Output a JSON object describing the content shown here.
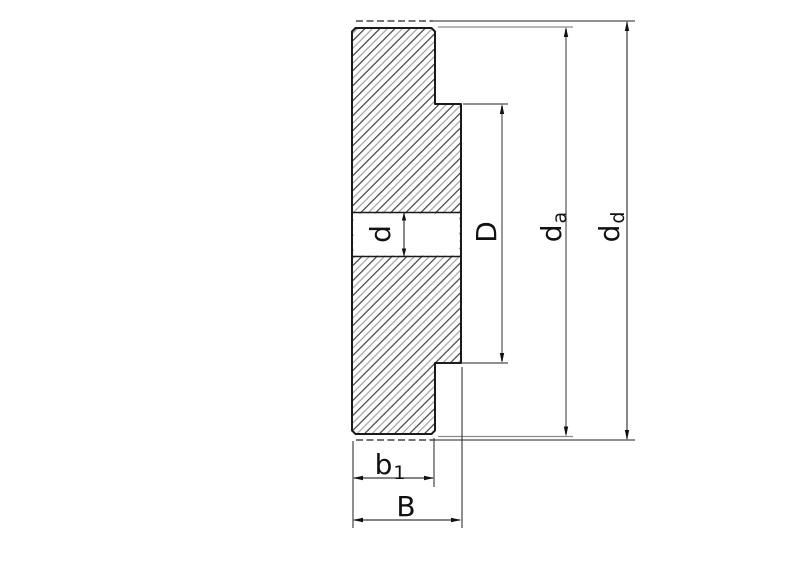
{
  "drawing": {
    "title": "gear-blank-cross-section",
    "labels": {
      "bore_diameter": {
        "base": "d",
        "sub": ""
      },
      "step_diameter": {
        "base": "D",
        "sub": ""
      },
      "outer_solid_diameter": {
        "base": "d",
        "sub": "a"
      },
      "outer_dashed_diameter": {
        "base": "d",
        "sub": "d"
      },
      "rim_width": {
        "base": "b",
        "sub": "1"
      },
      "total_width": {
        "base": "B",
        "sub": ""
      }
    },
    "colors": {
      "outline": "#1a1a1a",
      "thin_line": "#222222",
      "dim_line_gray": "#8c8c8c",
      "dim_line_dark": "#3a3a3a",
      "hatch_dark": "#2b2b2b",
      "hatch_gray": "#9b9b9b",
      "arrow": "#111111",
      "background": "#ffffff"
    }
  }
}
